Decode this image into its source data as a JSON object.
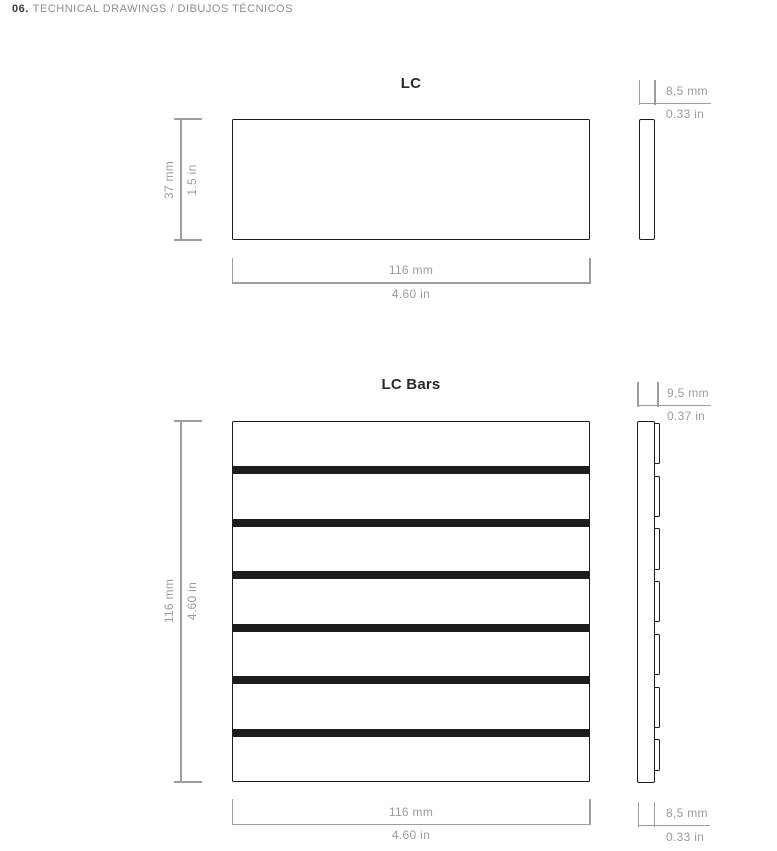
{
  "header": {
    "number": "06.",
    "title": "TECHNICAL DRAWINGS / DIBUJOS TÉCNICOS"
  },
  "colors": {
    "drawing_ink": "#1d1d1b",
    "dimension_gray": "#9d9d9c",
    "header_number": "#3a3a39",
    "header_title": "#8f8f8f",
    "figure_title": "#2d2a28",
    "background": "#ffffff"
  },
  "lc": {
    "title": "LC",
    "front": {
      "width_label_mm": "116 mm",
      "width_label_in": "4.60 in",
      "height_label_mm": "37 mm",
      "height_label_in": "1.5 in"
    },
    "side": {
      "thickness_label_mm": "8,5 mm",
      "thickness_label_in": "0.33 in"
    }
  },
  "lc_bars": {
    "title": "LC Bars",
    "front": {
      "width_label_mm": "116 mm",
      "width_label_in": "4.60 in",
      "height_label_mm": "116 mm",
      "height_label_in": "4.60 in",
      "slat_count": 7,
      "groove_count": 6
    },
    "side": {
      "top_thickness_label_mm": "9,5 mm",
      "top_thickness_label_in": "0.37 in",
      "bottom_thickness_label_mm": "8,5 mm",
      "bottom_thickness_label_in": "0.33 in"
    }
  }
}
